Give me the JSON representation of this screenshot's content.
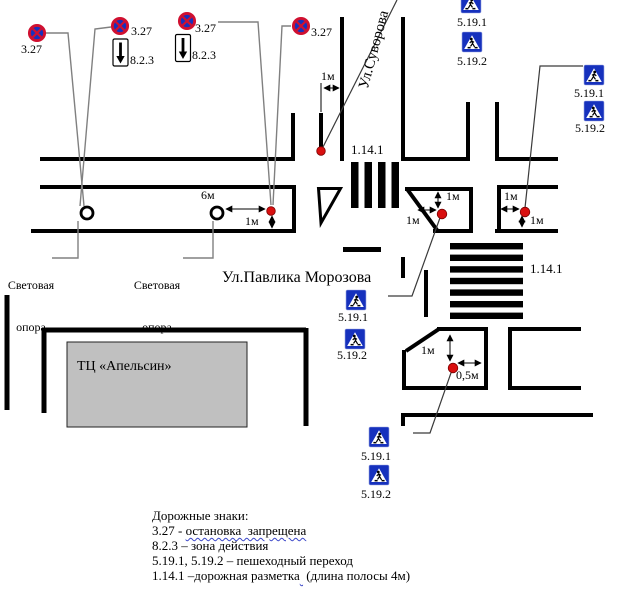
{
  "plan": {
    "street_vertical": "Ул.Суворова",
    "street_horizontal": "Ул.Павлика Морозова",
    "building_label": "ТЦ «Апельсин»",
    "light_pole_label_line1": "Световая",
    "light_pole_label_line2": "опора",
    "marking_label": "1.14.1",
    "sign_327": "3.27",
    "sign_823": "8.2.3",
    "sign_5191": "5.19.1",
    "sign_5192": "5.19.2",
    "dim_1m": "1м",
    "dim_6m": "6м",
    "dim_05m": "0,5м"
  },
  "legend": {
    "title": "Дорожные знаки:",
    "item_327_prefix": "3.27 - ",
    "item_327_term": "остановка  запрещена",
    "item_823": "8.2.3 – зона действия",
    "item_519": "5.19.1, 5.19.2 – пешеходный переход",
    "item_1141_prefix": "1.14.1 –дорожная разметка",
    "item_1141_suffix": " (длина полосы 4м)"
  },
  "colors": {
    "sign_blue": "#1631bd",
    "sign_red": "#d01030",
    "dot_red": "#d90f0f",
    "building_gray": "#c0c0c0"
  }
}
